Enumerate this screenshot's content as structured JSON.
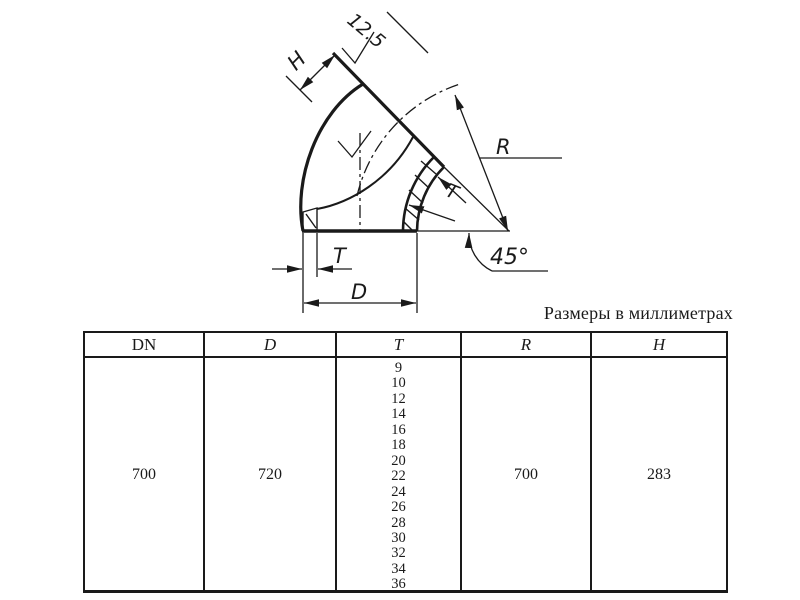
{
  "caption": "Размеры в миллиметрах",
  "drawing": {
    "roughness_label": "12.5",
    "h_dim_label": "H",
    "r_dim_label": "R",
    "t_dim_upper_label": "T",
    "t_dim_lower_label": "T",
    "d_dim_label": "D",
    "angle_label": "45°"
  },
  "table": {
    "headers": [
      "DN",
      "D",
      "T",
      "R",
      "H"
    ],
    "row": {
      "dn": "700",
      "d": "720",
      "t": [
        "9",
        "10",
        "12",
        "14",
        "16",
        "18",
        "20",
        "22",
        "24",
        "26",
        "28",
        "30",
        "32",
        "34",
        "36"
      ],
      "r": "700",
      "h": "283"
    }
  },
  "colors": {
    "line": "#1a1a1a",
    "background": "#ffffff"
  }
}
